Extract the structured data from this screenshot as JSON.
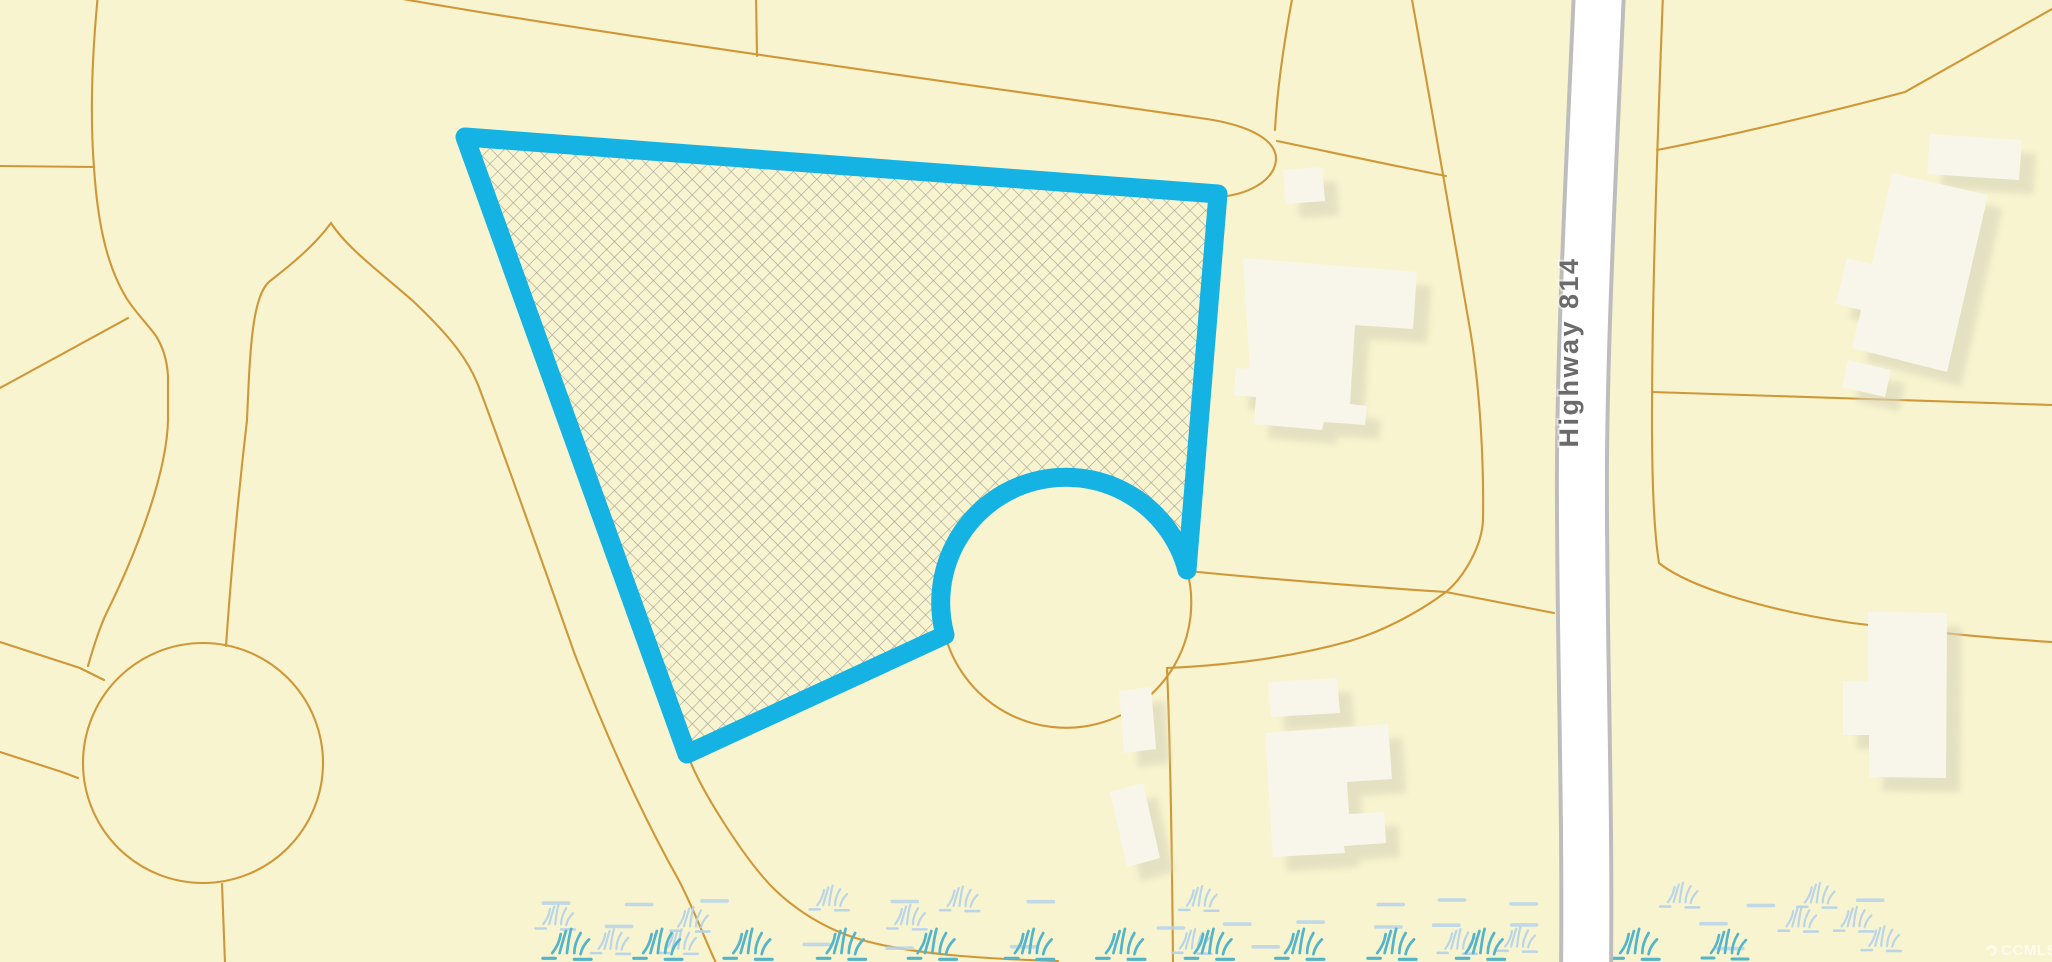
{
  "map": {
    "road_label": "Highway 814",
    "watermark_text": "CCMLS",
    "highlighted_parcel": {
      "style": "crosshatch",
      "outline_color": "#14b3e3"
    },
    "colors": {
      "bg": "#f8f4cf",
      "line": "#cf9737",
      "hl": "#14b3e3",
      "hatch": "#a3a29a",
      "road": "#ffffff",
      "casing": "#bdbdbd",
      "roadtext": "#6b6b6b",
      "bldg": "#f8f6ea",
      "shadow": "#d9d5ba",
      "wetl": "#b7d4ea",
      "wett": "#54b4ca",
      "wm": "#ffffff"
    }
  }
}
